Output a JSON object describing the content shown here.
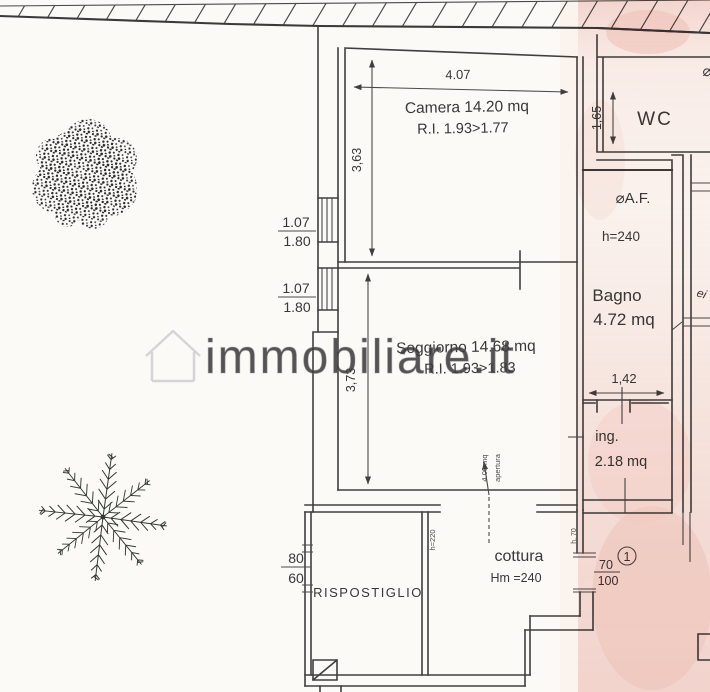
{
  "plan": {
    "watermark": "immobiliare.it",
    "rooms": {
      "camera": {
        "name": "Camera 14.20 mq",
        "ri": "R.I.  1.93>1.77"
      },
      "soggiorno": {
        "name": "Soggiorno  14.68 mq",
        "ri": "R.I.  1.93>1.83"
      },
      "wc": {
        "name": "WC"
      },
      "bagno": {
        "af": "⌀A.F.",
        "h": "h=240",
        "name": "Bagno",
        "area": "4.72 mq",
        "width": "1,42"
      },
      "ing": {
        "name": "ing.",
        "area": "2.18 mq"
      },
      "cottura": {
        "name": "cottura",
        "h": "Hm =240"
      },
      "ripostiglio": {
        "name": "RISPOSTIGLIO"
      }
    },
    "dims": {
      "camera_w": "4.07",
      "camera_h": "3,63",
      "soggiorno_h": "3,73",
      "wc_h": "1,65",
      "window1": {
        "top": "1.07",
        "bottom": "1.80"
      },
      "window2": {
        "top": "1.07",
        "bottom": "1.80"
      },
      "left_door": {
        "top": "80",
        "bottom": "60"
      },
      "right_door": {
        "top": "70",
        "bottom": "100"
      }
    },
    "notes": {
      "opening_line1": "apertura",
      "opening_line2": "4.00 mq",
      "door_h": "h=220",
      "wall_h": "h. 70",
      "handwriting": "ei"
    },
    "annotations": {
      "unit": "1",
      "af_partial": "⌀"
    },
    "colors": {
      "ink": "#3f3f3f",
      "paper": "#fcfaf7",
      "scan_tint": "#eeb4ab",
      "watermark_gray": "#87878c"
    }
  }
}
